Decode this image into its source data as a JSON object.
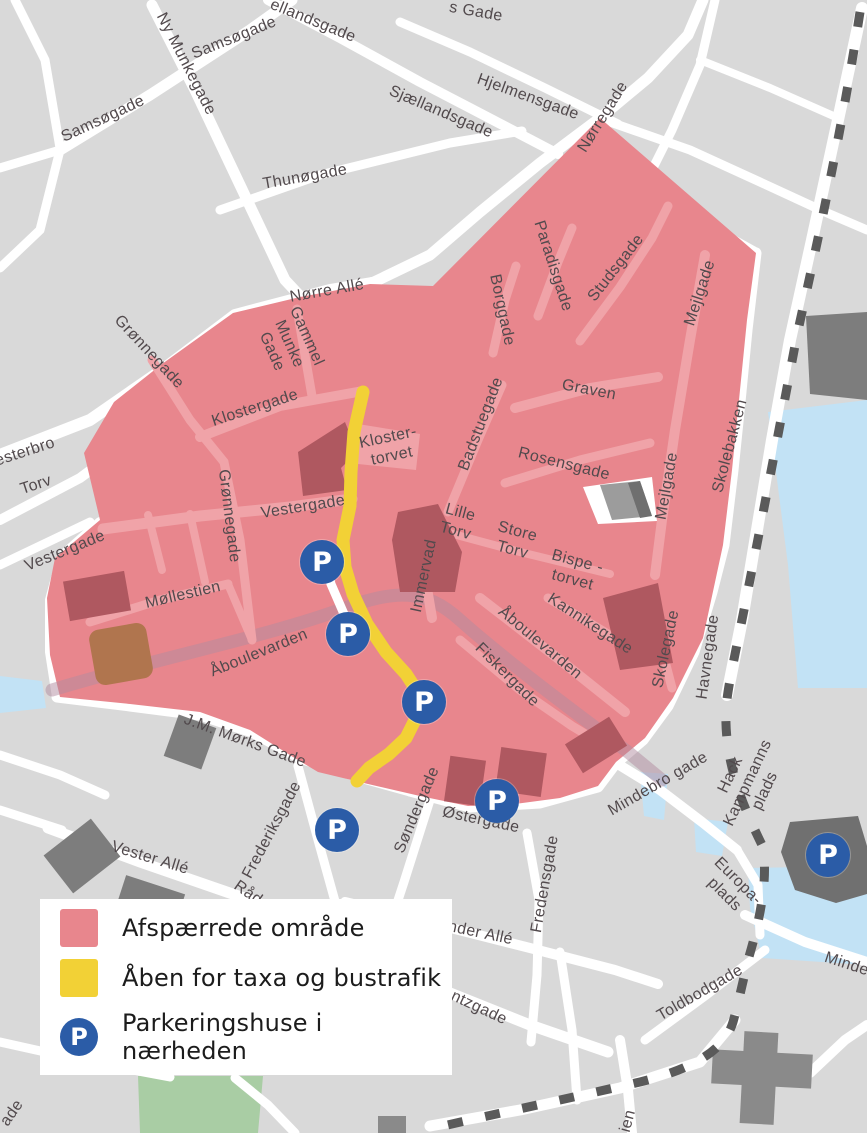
{
  "legend": {
    "items": [
      {
        "id": "closed-area",
        "label": "Afspærrede område",
        "color": "#e8868d",
        "icon": ""
      },
      {
        "id": "taxi-bus-route",
        "label": "Åben for taxa og bustrafik",
        "color": "#f2d136",
        "icon": ""
      },
      {
        "id": "parking",
        "label": "Parkeringshuse i nærheden",
        "color": "#2b5ca7",
        "icon": "P"
      }
    ]
  },
  "map": {
    "parking_icon": "P",
    "colors": {
      "background": "#d9d9d9",
      "road": "#ffffff",
      "closed_area": "#e8868d",
      "closed_area_street": "#f0a3a8",
      "closed_area_building": "#af5860",
      "brown_building": "#b0754e",
      "river_band": "#b28ba0",
      "route_yellow": "#f2d136",
      "parking_blue": "#2b5ca7",
      "water": "#c2e2f5",
      "park_green": "#a9cda4",
      "gray_building": "#7d7d7d",
      "rail_dash": "#5a5a5a",
      "label_text": "#524a4d"
    },
    "street_labels": [
      {
        "text": "s Gade",
        "x": 476,
        "y": 12,
        "rot": 10
      },
      {
        "text": "ellandsgade",
        "x": 313,
        "y": 21,
        "rot": 22
      },
      {
        "text": "Samsøgade",
        "x": 234,
        "y": 38,
        "rot": -22
      },
      {
        "text": "Ny Munkegade",
        "x": 186,
        "y": 64,
        "rot": 63
      },
      {
        "text": "Samsøgade",
        "x": 103,
        "y": 119,
        "rot": -25
      },
      {
        "text": "Sjællandsgade",
        "x": 441,
        "y": 112,
        "rot": 23
      },
      {
        "text": "Hjelmensgade",
        "x": 528,
        "y": 97,
        "rot": 20
      },
      {
        "text": "Thunøgade",
        "x": 305,
        "y": 177,
        "rot": -10
      },
      {
        "text": "Nørregade",
        "x": 603,
        "y": 117,
        "rot": -58
      },
      {
        "text": "Nørre Allé",
        "x": 327,
        "y": 291,
        "rot": -10
      },
      {
        "text": "Grønnegade",
        "x": 149,
        "y": 352,
        "rot": 47
      },
      {
        "text": "esterbro",
        "x": 25,
        "y": 452,
        "rot": -18
      },
      {
        "text": "Torv",
        "x": 36,
        "y": 485,
        "rot": -18
      },
      {
        "text": "Vestergade",
        "x": 65,
        "y": 551,
        "rot": -22
      },
      {
        "text": "Gammel\nMunke\nGade",
        "x": 289,
        "y": 344,
        "rot": 66
      },
      {
        "text": "Klostergade",
        "x": 255,
        "y": 408,
        "rot": -18
      },
      {
        "text": "Kloster-\ntorvet",
        "x": 390,
        "y": 447,
        "rot": -12
      },
      {
        "text": "Grønnegade",
        "x": 229,
        "y": 516,
        "rot": 83
      },
      {
        "text": "Vestergade",
        "x": 303,
        "y": 507,
        "rot": -9
      },
      {
        "text": "Møllestien",
        "x": 183,
        "y": 595,
        "rot": -13
      },
      {
        "text": "Åboulevarden",
        "x": 259,
        "y": 653,
        "rot": -22
      },
      {
        "text": "Paradisgade",
        "x": 553,
        "y": 266,
        "rot": 72
      },
      {
        "text": "Borggade",
        "x": 502,
        "y": 310,
        "rot": 78
      },
      {
        "text": "Studsgade",
        "x": 616,
        "y": 268,
        "rot": -52
      },
      {
        "text": "Mejlgade",
        "x": 700,
        "y": 293,
        "rot": -72
      },
      {
        "text": "Graven",
        "x": 589,
        "y": 390,
        "rot": 11
      },
      {
        "text": "Badstuegade",
        "x": 481,
        "y": 424,
        "rot": -69
      },
      {
        "text": "Rosensgade",
        "x": 564,
        "y": 464,
        "rot": 14
      },
      {
        "text": "Mejlgade",
        "x": 667,
        "y": 486,
        "rot": -80
      },
      {
        "text": "Lille\nTorv",
        "x": 458,
        "y": 522,
        "rot": 15
      },
      {
        "text": "Store\nTorv",
        "x": 515,
        "y": 541,
        "rot": 15
      },
      {
        "text": "Bispe -\ntorvet",
        "x": 575,
        "y": 571,
        "rot": 15
      },
      {
        "text": "Immervad",
        "x": 424,
        "y": 576,
        "rot": -78
      },
      {
        "text": "Åboulevarden",
        "x": 540,
        "y": 643,
        "rot": 40
      },
      {
        "text": "Kannikegade",
        "x": 590,
        "y": 624,
        "rot": 33
      },
      {
        "text": "Fiskergade",
        "x": 507,
        "y": 675,
        "rot": 45
      },
      {
        "text": "Skolegade",
        "x": 666,
        "y": 649,
        "rot": -78
      },
      {
        "text": "Skolebakken",
        "x": 730,
        "y": 446,
        "rot": -75
      },
      {
        "text": "Havnegade",
        "x": 708,
        "y": 657,
        "rot": -82
      },
      {
        "text": "Mindebro gade",
        "x": 658,
        "y": 784,
        "rot": -30
      },
      {
        "text": "Hack\nKampmanns\nplads",
        "x": 748,
        "y": 783,
        "rot": -65
      },
      {
        "text": "J.M. Mørks Gade",
        "x": 245,
        "y": 741,
        "rot": 20
      },
      {
        "text": "Vester Allé",
        "x": 150,
        "y": 858,
        "rot": 17
      },
      {
        "text": "Frederiksgade",
        "x": 272,
        "y": 830,
        "rot": -62
      },
      {
        "text": "Råd",
        "x": 248,
        "y": 893,
        "rot": 35
      },
      {
        "text": "Søndergade",
        "x": 417,
        "y": 810,
        "rot": -67
      },
      {
        "text": "Østergade",
        "x": 481,
        "y": 820,
        "rot": 12
      },
      {
        "text": "Fredensgade",
        "x": 545,
        "y": 884,
        "rot": -80
      },
      {
        "text": "Sønder Allé",
        "x": 470,
        "y": 931,
        "rot": 12
      },
      {
        "text": "n  krantzgade",
        "x": 462,
        "y": 1000,
        "rot": 25
      },
      {
        "text": "Toldbodgade",
        "x": 700,
        "y": 993,
        "rot": -30
      },
      {
        "text": "Europa-\nplads",
        "x": 731,
        "y": 888,
        "rot": 45
      },
      {
        "text": "Mindet",
        "x": 849,
        "y": 965,
        "rot": 18
      },
      {
        "text": "ien",
        "x": 628,
        "y": 1121,
        "rot": -75
      },
      {
        "text": "ade",
        "x": 12,
        "y": 1113,
        "rot": -55
      }
    ],
    "parking_markers": [
      {
        "x": 322,
        "y": 562
      },
      {
        "x": 348,
        "y": 634
      },
      {
        "x": 424,
        "y": 702
      },
      {
        "x": 497,
        "y": 801
      },
      {
        "x": 337,
        "y": 830
      },
      {
        "x": 828,
        "y": 855
      }
    ]
  }
}
